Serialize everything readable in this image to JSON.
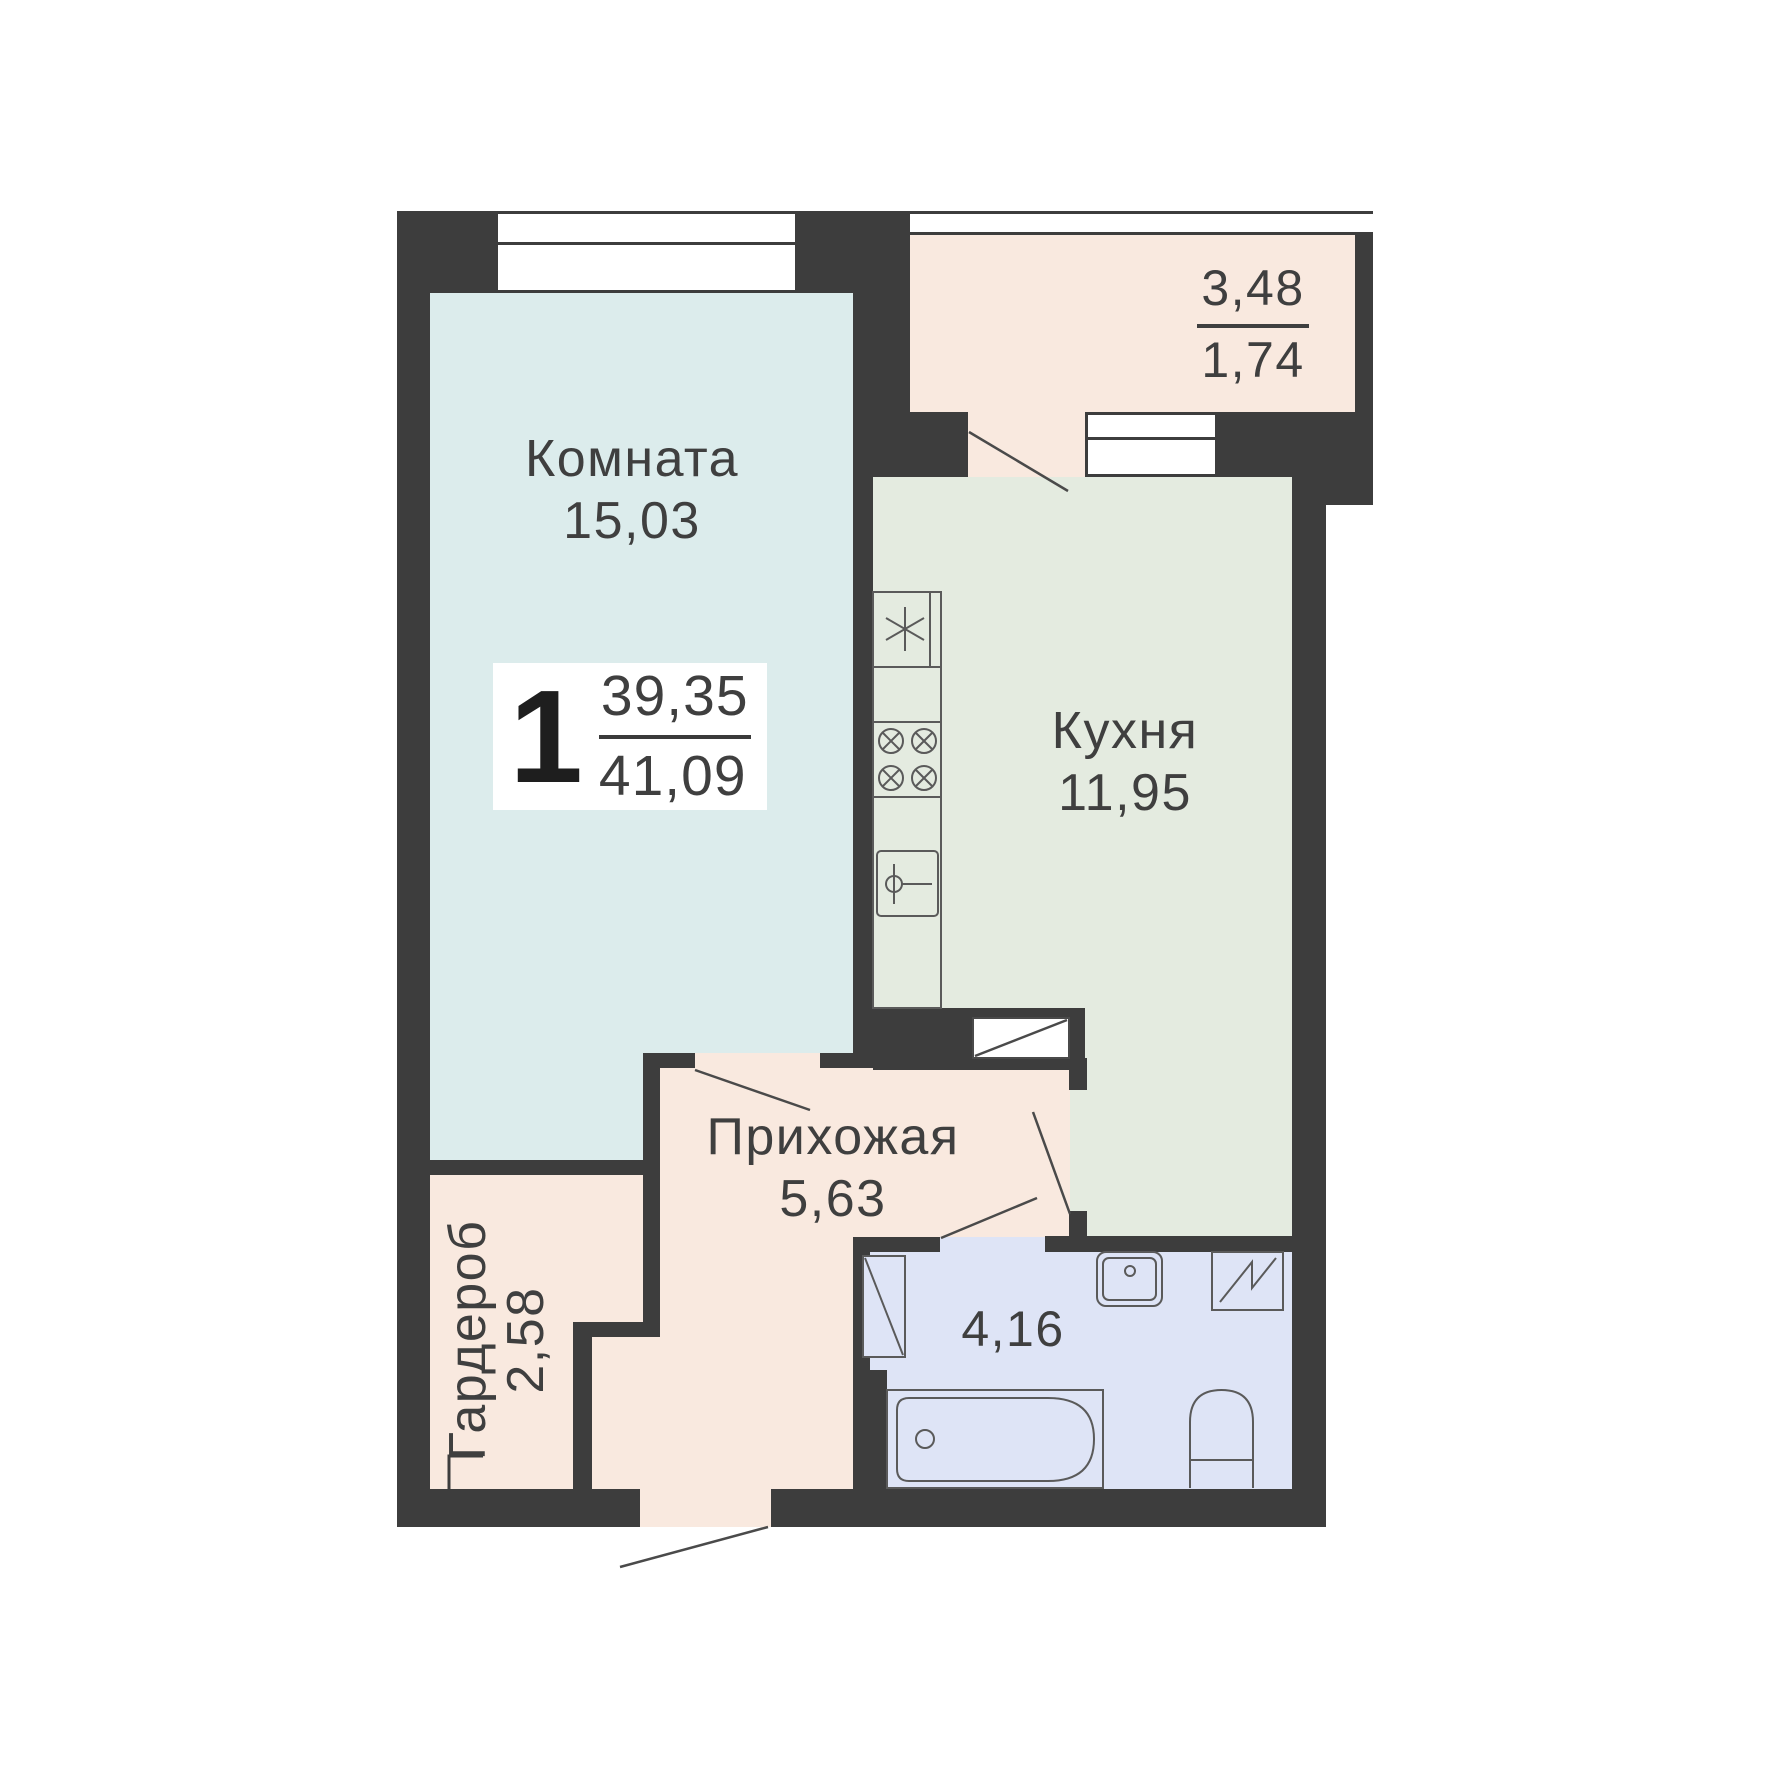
{
  "colors": {
    "bg": "#ffffff",
    "wall": "#3d3d3d",
    "room": "#dcecec",
    "kitchen": "#e4ebe0",
    "warm": "#f9e9df",
    "bath": "#dee4f6",
    "line": "#4a4a4a",
    "fixture": "#5a5a5a",
    "text": "#3f3f3f"
  },
  "summary": {
    "rooms_count": "1",
    "living_area": "39,35",
    "total_area": "41,09"
  },
  "rooms": {
    "living": {
      "name": "Комната",
      "area": "15,03"
    },
    "kitchen": {
      "name": "Кухня",
      "area": "11,95"
    },
    "hallway": {
      "name": "Прихожая",
      "area": "5,63"
    },
    "wardrobe": {
      "name": "Гардероб",
      "area": "2,58"
    },
    "bathroom": {
      "area": "4,16"
    },
    "balcony": {
      "area_total": "3,48",
      "area_reduced": "1,74"
    }
  }
}
